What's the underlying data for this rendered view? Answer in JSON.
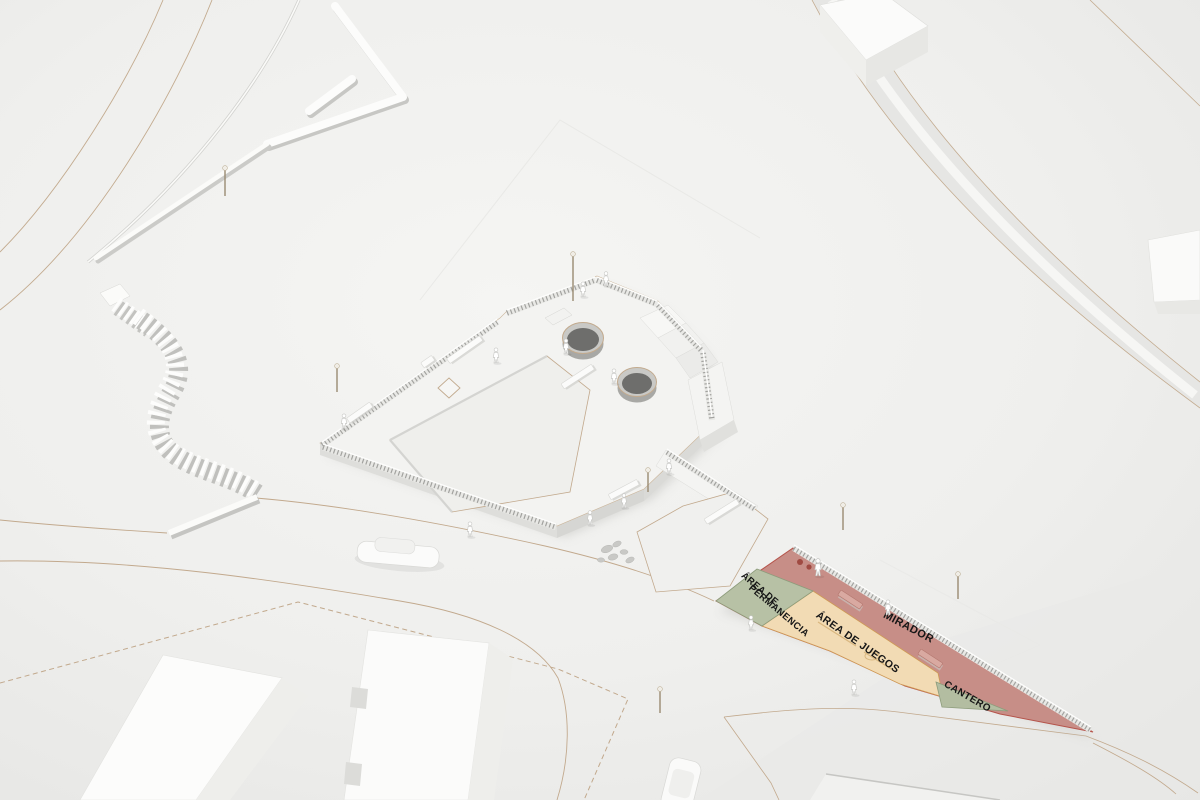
{
  "scene": {
    "type": "architectural-site-render",
    "description": "Aerial white 3D massing model of a plaza and mirador park with labeled program zones"
  },
  "zones": {
    "permanencia": {
      "line1": "ÁREA DE",
      "line2": "PERMANENCIA",
      "color": "#b7c1a5",
      "outline": "#8d9c7b"
    },
    "juegos": {
      "label": "ÁREA DE JUEGOS",
      "color": "#f2dbb4",
      "outline": "#cf9a55"
    },
    "mirador": {
      "label": "MIRADOR",
      "color": "#c78e87",
      "outline": "#b5544b"
    },
    "cantero": {
      "label": "CANTERO",
      "color": "#b3bda1",
      "outline": "#8d9c7b"
    }
  },
  "palette": {
    "terrain": "#efefed",
    "site_lines": "#c2a98d",
    "model_white": "#fbfbfa",
    "model_shade": "#e4e4e1",
    "railing": "#a2a29f",
    "cylinder_interior": "#6e6e6c"
  }
}
